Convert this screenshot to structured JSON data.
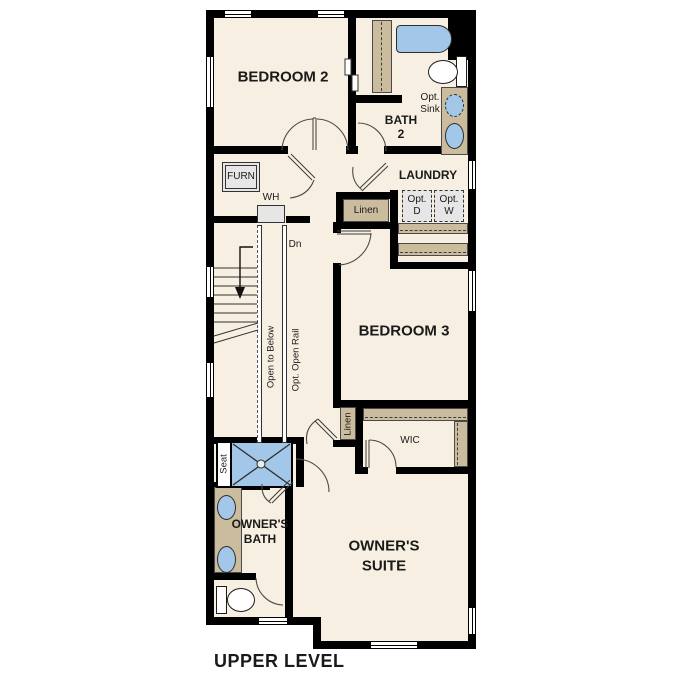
{
  "plan_title": "UPPER LEVEL",
  "rooms": {
    "bedroom2": {
      "label": "BEDROOM 2"
    },
    "bath2": {
      "line1": "BATH",
      "line2": "2"
    },
    "laundry": {
      "label": "LAUNDRY"
    },
    "bedroom3": {
      "label": "BEDROOM 3"
    },
    "wic": {
      "label": "WIC"
    },
    "owners_bath": {
      "line1": "OWNER'S",
      "line2": "BATH"
    },
    "owners_suite": {
      "line1": "OWNER'S",
      "line2": "SUITE"
    }
  },
  "features": {
    "furnace": "FURN",
    "water_heater": "WH",
    "stairs_down": "Dn",
    "linen_hall": "Linen",
    "linen_owners": "Linen",
    "open_to_below": "Open to Below",
    "opt_open_rail": "Opt. Open Rail",
    "shower_seat": "Seat",
    "opt_sink": {
      "line1": "Opt.",
      "line2": "Sink"
    },
    "opt_dryer": {
      "line1": "Opt.",
      "line2": "D"
    },
    "opt_washer": {
      "line1": "Opt.",
      "line2": "W"
    }
  },
  "colors": {
    "wall": "#000000",
    "floor": "#f7efe1",
    "closet": "#cbbc9e",
    "fixture": "#a3c7e8",
    "equipment": "#e6e6e6",
    "background": "#ffffff"
  }
}
